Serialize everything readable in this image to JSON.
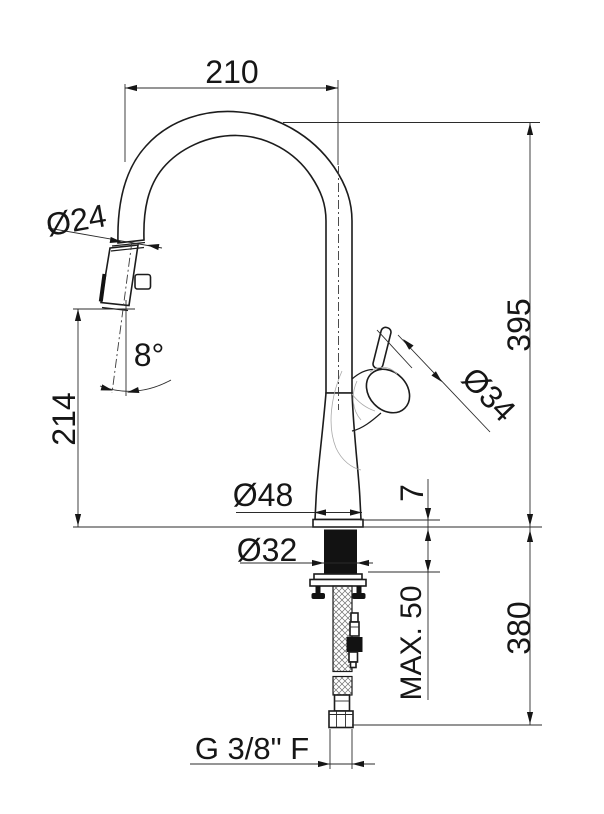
{
  "title": "Kitchen pull-out faucet technical dimensional drawing",
  "labels": {
    "spout_reach": "210",
    "spray_head_diameter": "Ø24",
    "spray_head_angle": "8°",
    "outlet_height": "214",
    "total_height": "395",
    "handle_diameter": "Ø34",
    "base_diameter": "Ø48",
    "base_plate_height": "7",
    "shank_diameter": "Ø32",
    "max_counter_thickness": "MAX. 50",
    "hose_length": "380",
    "supply_connection": "G 3/8\" F"
  },
  "colors": {
    "line": "#1c1c1c",
    "dark_fill": "#121212",
    "background": "#ffffff",
    "sketch_line": "#a9a9a9"
  }
}
